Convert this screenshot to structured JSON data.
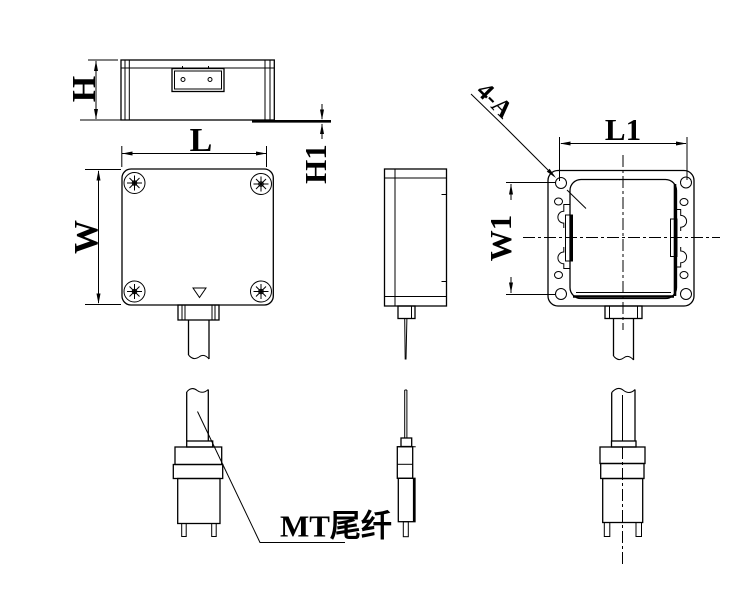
{
  "colors": {
    "background": "#ffffff",
    "line": "#000000"
  },
  "labels": {
    "dim_h": "H",
    "dim_l": "L",
    "dim_h1": "H1",
    "dim_w": "W",
    "dim_l1": "L1",
    "dim_w1": "W1",
    "holes_note": "4-A",
    "pigtail_note": "MT尾纤"
  }
}
